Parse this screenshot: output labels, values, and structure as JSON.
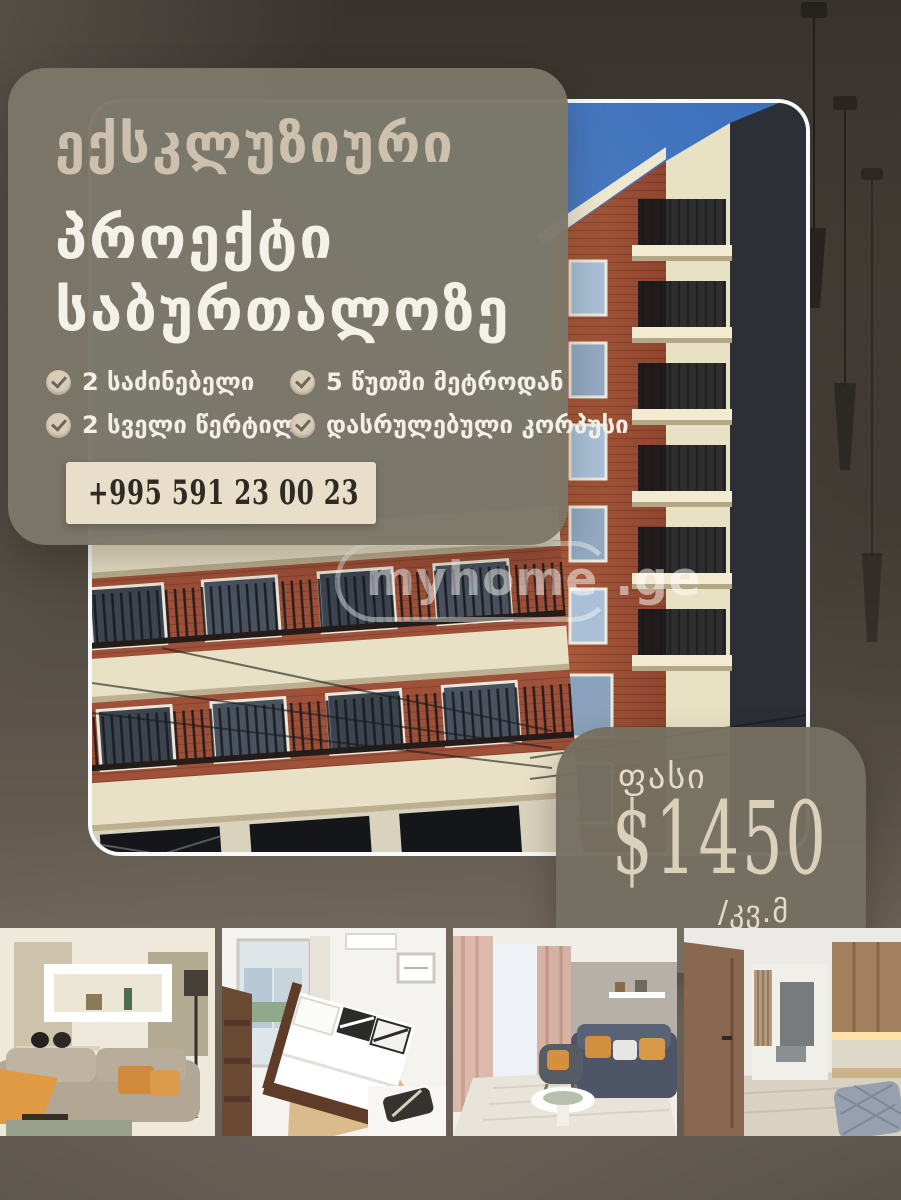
{
  "poster": {
    "headline": {
      "line1": "ექსკლუზიური",
      "line2": "პროექტი",
      "line3": "საბურთალოზე"
    },
    "features": [
      {
        "label": "2 საძინებელი"
      },
      {
        "label": "5 წუთში მეტროდან"
      },
      {
        "label": "2 სველი წერტილი"
      },
      {
        "label": "დასრულებული კორპუსი"
      }
    ],
    "phone": "+995 591 23 00 23",
    "price": {
      "label": "ფასი",
      "amount": "$1450",
      "per_unit": "/კვ.მ"
    },
    "watermark": {
      "name": "myhome",
      "tld": ".ge"
    },
    "colors": {
      "panel": "#7c7768",
      "accent_beige": "#cdc0ac",
      "text_white": "#f4f1e8",
      "phone_bg": "#e9dec9",
      "price_card": "#757161"
    }
  }
}
